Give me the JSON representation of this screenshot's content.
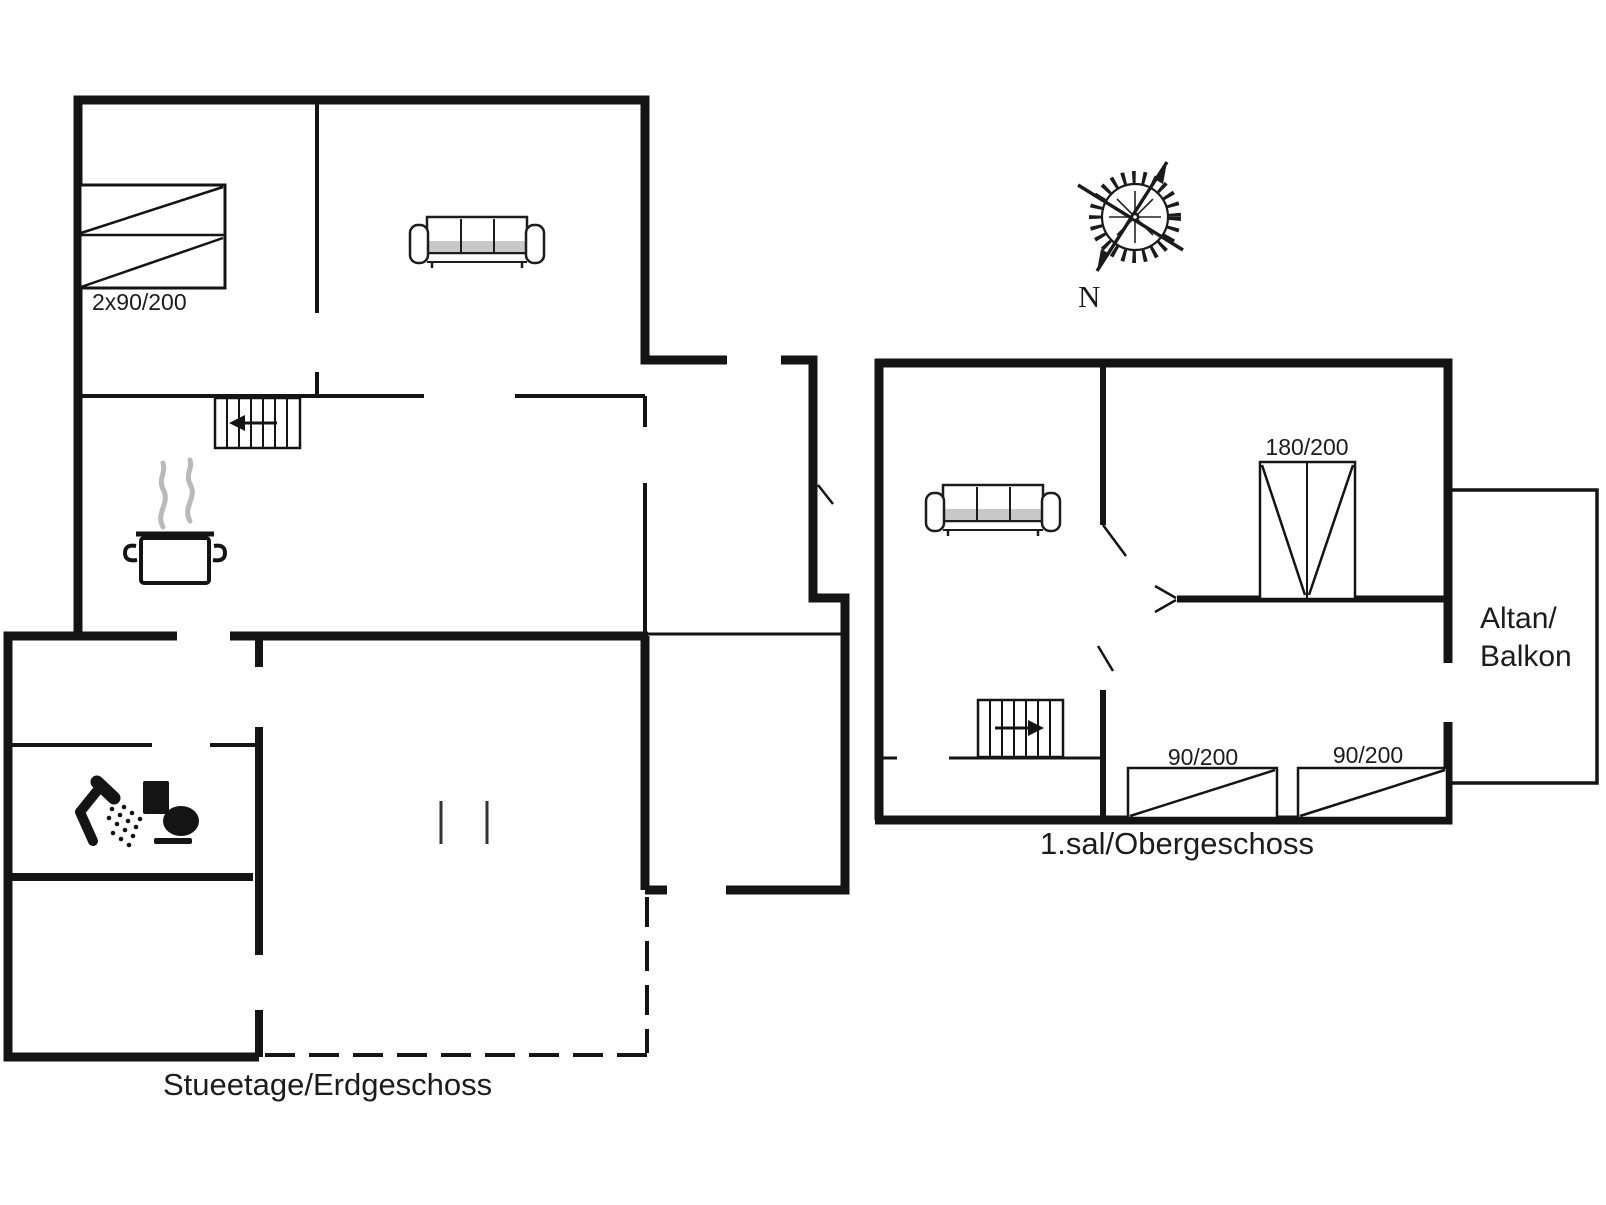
{
  "ground_floor": {
    "label": "Stueetage/Erdgeschoss",
    "bed_size_label": "2x90/200"
  },
  "upper_floor": {
    "label": "1.sal/Obergeschoss",
    "wardrobe_size_label": "180/200",
    "bed_left_size_label": "90/200",
    "bed_right_size_label": "90/200",
    "balcony_label_line1": "Altan/",
    "balcony_label_line2": "Balkon"
  },
  "compass": {
    "north_label": "N"
  },
  "colors": {
    "wall": "#141414",
    "text": "#1c1c1c",
    "steam": "#b9b9b9",
    "seat_shading": "#c8c8c8"
  }
}
